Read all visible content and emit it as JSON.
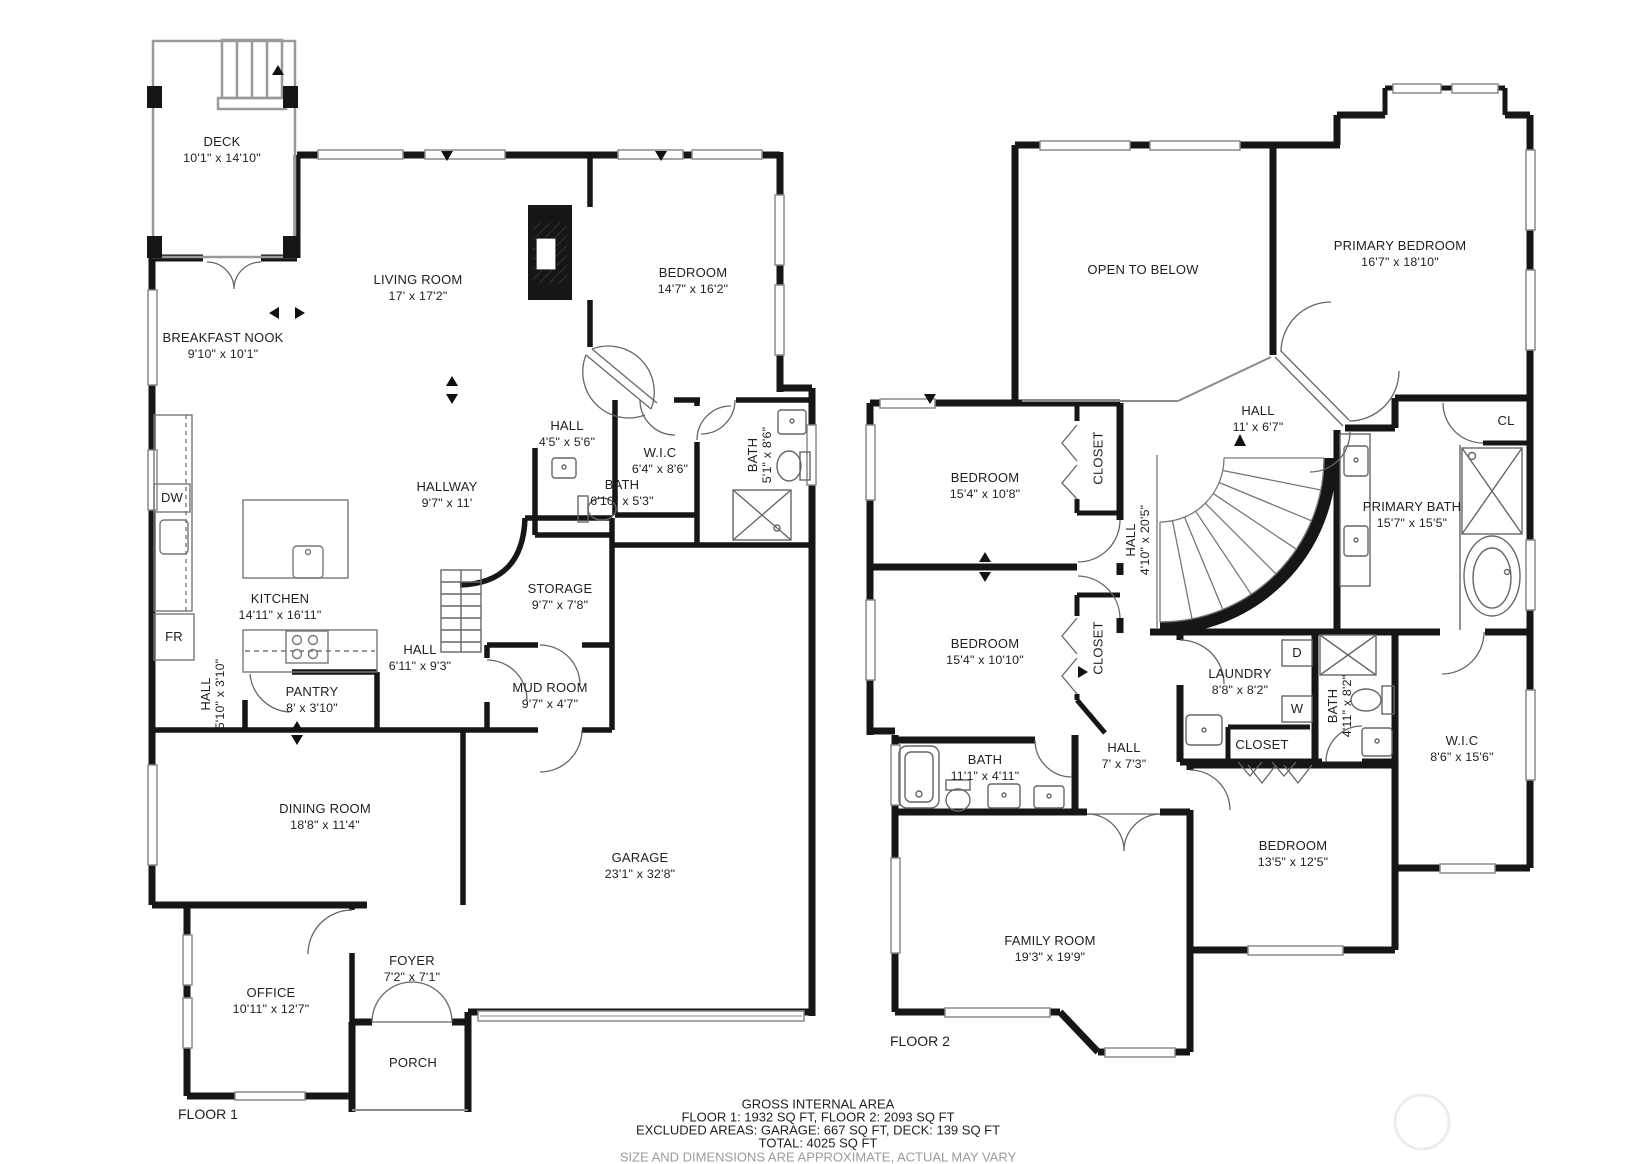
{
  "floor1": {
    "floor_label": "FLOOR 1",
    "deck": {
      "name": "DECK",
      "dims": "10'1\" x 14'10\""
    },
    "breakfast_nook": {
      "name": "BREAKFAST NOOK",
      "dims": "9'10\" x 10'1\""
    },
    "living_room": {
      "name": "LIVING ROOM",
      "dims": "17' x 17'2\""
    },
    "bedroom": {
      "name": "BEDROOM",
      "dims": "14'7\" x 16'2\""
    },
    "hall_a": {
      "name": "HALL",
      "dims": "4'5\" x 5'6\""
    },
    "wic": {
      "name": "W.I.C",
      "dims": "6'4\" x 8'6\""
    },
    "bath_a": {
      "name": "BATH",
      "dims": "5'1\" x 8'6\""
    },
    "bath_b": {
      "name": "BATH",
      "dims": "6'10\" x 5'3\""
    },
    "hallway": {
      "name": "HALLWAY",
      "dims": "9'7\" x 11'"
    },
    "kitchen": {
      "name": "KITCHEN",
      "dims": "14'11\" x 16'11\""
    },
    "storage": {
      "name": "STORAGE",
      "dims": "9'7\" x 7'8\""
    },
    "hall_b": {
      "name": "HALL",
      "dims": "6'11\" x 9'3\""
    },
    "hall_c": {
      "name": "HALL",
      "dims": "5'10\" x 3'10\""
    },
    "pantry": {
      "name": "PANTRY",
      "dims": "8' x 3'10\""
    },
    "mud_room": {
      "name": "MUD ROOM",
      "dims": "9'7\" x 4'7\""
    },
    "dining_room": {
      "name": "DINING ROOM",
      "dims": "18'8\" x 11'4\""
    },
    "garage": {
      "name": "GARAGE",
      "dims": "23'1\" x 32'8\""
    },
    "office": {
      "name": "OFFICE",
      "dims": "10'11\" x 12'7\""
    },
    "foyer": {
      "name": "FOYER",
      "dims": "7'2\" x 7'1\""
    },
    "porch": {
      "name": "PORCH"
    },
    "appliance_dw": "DW",
    "appliance_fr": "FR"
  },
  "floor2": {
    "floor_label": "FLOOR 2",
    "open_to_below": {
      "name": "OPEN TO BELOW"
    },
    "primary_bedroom": {
      "name": "PRIMARY BEDROOM",
      "dims": "16'7\" x 18'10\""
    },
    "hall_a": {
      "name": "HALL",
      "dims": "11' x 6'7\""
    },
    "bedroom_a": {
      "name": "BEDROOM",
      "dims": "15'4\" x 10'8\""
    },
    "closet_a": {
      "name": "CLOSET"
    },
    "bedroom_b": {
      "name": "BEDROOM",
      "dims": "15'4\" x 10'10\""
    },
    "closet_b": {
      "name": "CLOSET"
    },
    "hall_b": {
      "name": "HALL",
      "dims": "4'10\" x 20'5\""
    },
    "primary_bath": {
      "name": "PRIMARY BATH",
      "dims": "15'7\" x 15'5\""
    },
    "closet_cl": {
      "name": "CL"
    },
    "laundry": {
      "name": "LAUNDRY",
      "dims": "8'8\" x 8'2\""
    },
    "closet_c": {
      "name": "CLOSET"
    },
    "bath_a": {
      "name": "BATH",
      "dims": "4'11\" x 8'2\""
    },
    "wic": {
      "name": "W.I.C",
      "dims": "8'6\" x 15'6\""
    },
    "hall_c": {
      "name": "HALL",
      "dims": "7' x 7'3\""
    },
    "bath_b": {
      "name": "BATH",
      "dims": "11'1\" x 4'11\""
    },
    "family_room": {
      "name": "FAMILY ROOM",
      "dims": "19'3\" x 19'9\""
    },
    "bedroom_c": {
      "name": "BEDROOM",
      "dims": "13'5\" x 12'5\""
    },
    "appliance_d": "D",
    "appliance_w": "W"
  },
  "footer": {
    "title": "GROSS INTERNAL AREA",
    "line1": "FLOOR 1: 1932 SQ FT, FLOOR 2: 2093 SQ FT",
    "line2": "EXCLUDED AREAS: GARAGE: 667 SQ FT, DECK: 139 SQ FT",
    "line3": "TOTAL: 4025 SQ FT",
    "disclaimer": "SIZE AND DIMENSIONS ARE APPROXIMATE, ACTUAL MAY VARY"
  },
  "colors": {
    "wall": "#161616",
    "window": "#8a8a8a",
    "text": "#1f1f1f",
    "muted": "#9b9b9b"
  }
}
